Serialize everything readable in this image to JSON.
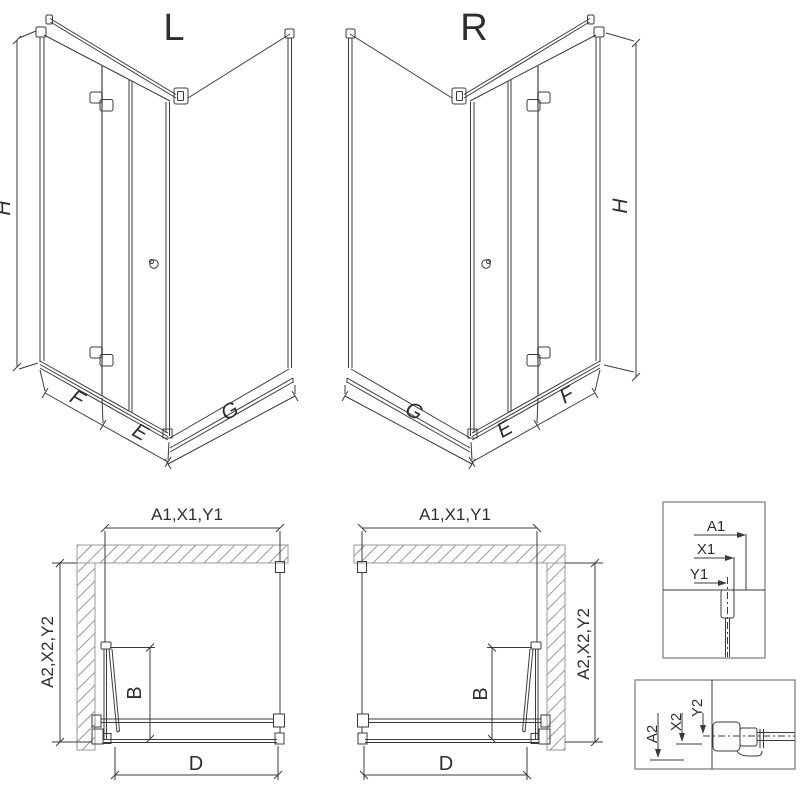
{
  "views": {
    "iso_left": {
      "title": "L",
      "height_label": "H",
      "fixed_panel_label": "F",
      "door_label": "E",
      "side_panel_label": "G"
    },
    "iso_right": {
      "title": "R",
      "height_label": "H",
      "fixed_panel_label": "F",
      "door_label": "E",
      "side_panel_label": "G"
    },
    "plan_left": {
      "width_dims": "A1,X1,Y1",
      "depth_dims": "A2,X2,Y2",
      "door_dim": "B",
      "entry_dim": "D"
    },
    "plan_right": {
      "width_dims": "A1,X1,Y1",
      "depth_dims": "A2,X2,Y2",
      "door_dim": "B",
      "entry_dim": "D"
    },
    "detail_wall_profile": {
      "dims": [
        "A1",
        "X1",
        "Y1"
      ]
    },
    "detail_bottom_profile": {
      "dims": [
        "A2",
        "X2",
        "Y2"
      ]
    }
  },
  "colors": {
    "line": "#3b3b3b",
    "hatch": "#9a9a9a",
    "box_border": "#8c8c8c",
    "background": "#ffffff"
  }
}
